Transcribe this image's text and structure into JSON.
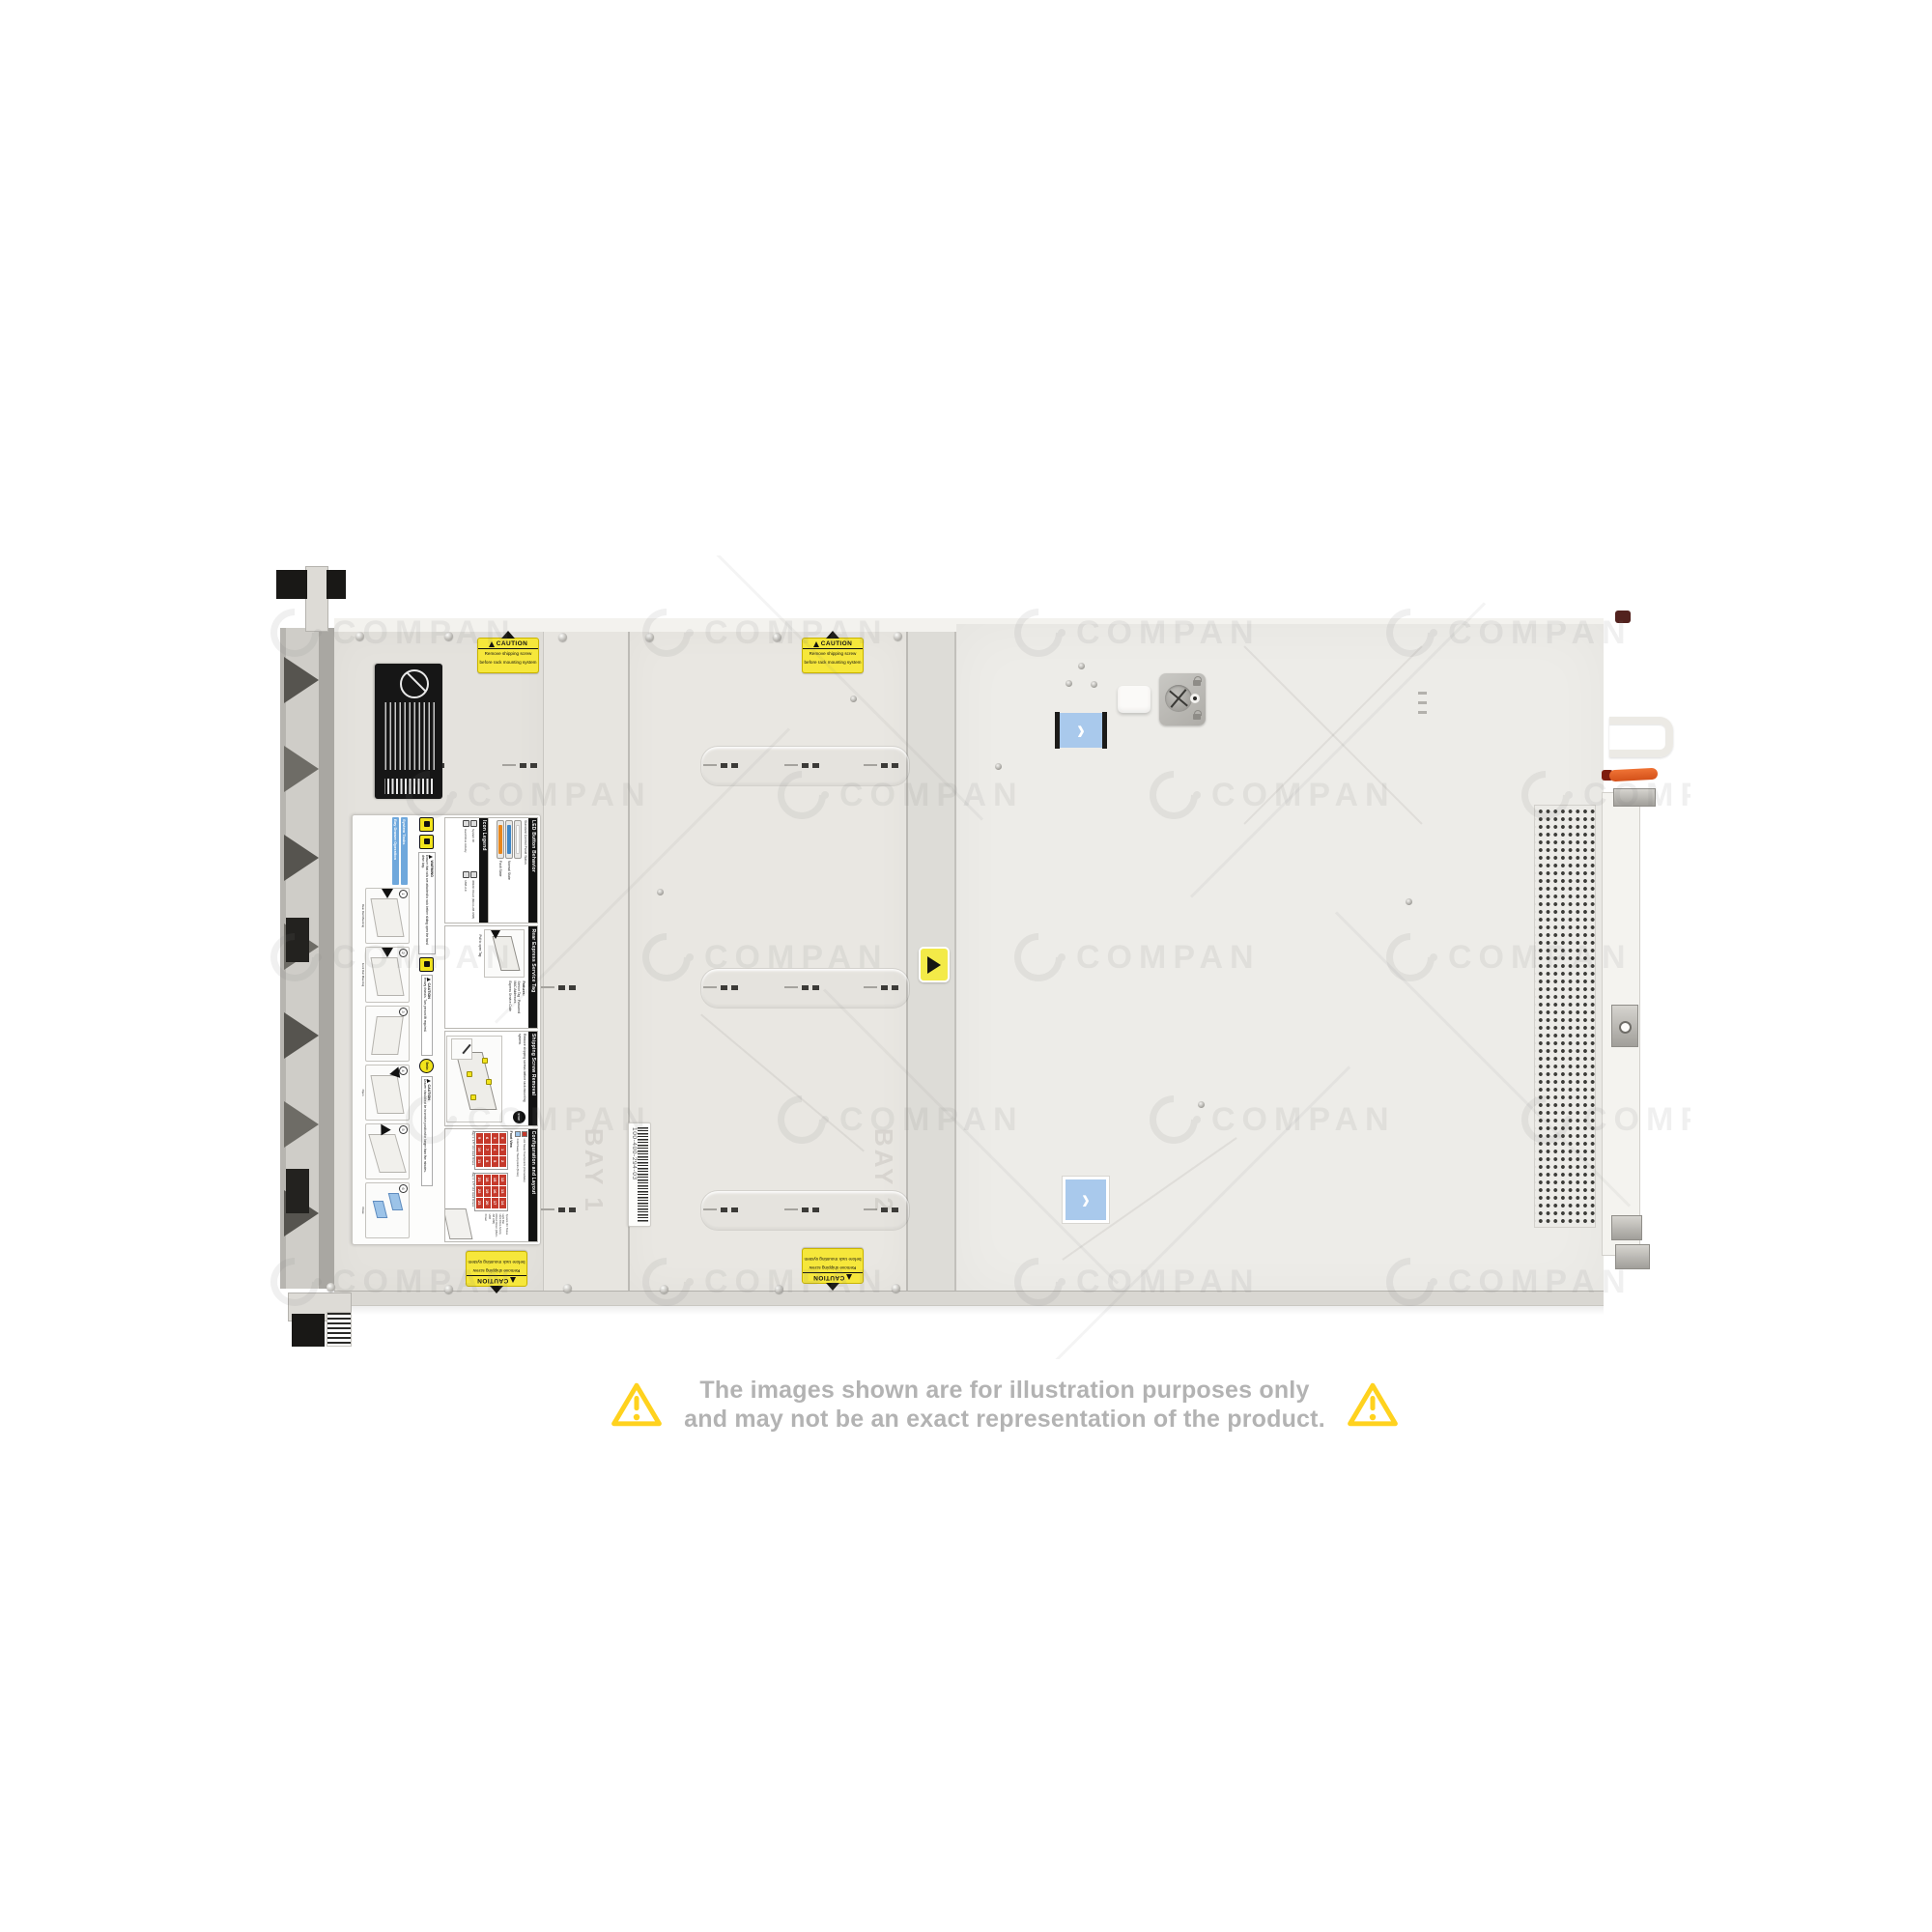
{
  "watermark": {
    "text": "COMPAN"
  },
  "disclaimer": {
    "line1": "The images shown are for illustration purposes only",
    "line2": "and may not be an exact representation of the product."
  },
  "caution_label": {
    "header": "CAUTION",
    "line1": "Remove shipping screw",
    "line2": "before rack mounting system"
  },
  "barcode_label": {
    "text": "100-400-294-03"
  },
  "embossed": {
    "bay1": "BAY 1",
    "bay2": "BAY 2"
  },
  "service_label": {
    "led_section": {
      "title": "LED Button Behavior",
      "subtitle": "Standard Control Panel Status",
      "states": [
        {
          "label": "",
          "color": "#fbfbfa"
        },
        {
          "label": "Normal State",
          "color": "#3f86c6"
        },
        {
          "label": "Fault State",
          "color": "#e8861a"
        }
      ]
    },
    "icon_legend": {
      "title": "Icon Legend",
      "items": [
        "System ID",
        "iDRAC Direct (Micro-AB USB)",
        "Hard Drive Activity",
        "USB 2.0"
      ]
    },
    "service_tag": {
      "title": "Rear Express Service Tag",
      "features_label": "Features:",
      "features": [
        "Service Tag",
        "Password",
        "MAC Addresses",
        "Express Service Code"
      ],
      "note": "Pull to open Tag"
    },
    "shipping": {
      "title": "Shipping Screw Removal",
      "badge": "STOP",
      "text": "Remove shipping screws before rack mounting system."
    },
    "config": {
      "title": "Configuration and Layout",
      "legend": [
        {
          "label": "Hot Swap Touchpoints (Immediate)",
          "color": "#c5392b"
        },
        {
          "label": "Cold Swap Touchpoints (5min)",
          "color": "#9cc3e8"
        }
      ],
      "front_view": "Front View",
      "bay1_label": "Bay 1: 3.5\" x12 Hard Drives",
      "bay2_label": "Bay 2: 3.5\" x12 Hard Drives",
      "bay1_numbers": [
        "0",
        "1",
        "2",
        "3",
        "4",
        "5",
        "6",
        "7",
        "8",
        "9",
        "10",
        "11"
      ],
      "bay2_numbers": [
        "12",
        "13",
        "14",
        "15",
        "16",
        "17",
        "18",
        "19",
        "20",
        "21",
        "22",
        "23"
      ],
      "annotations": [
        "System ID / Status Light Bar",
        "Hard Drive Activity",
        "iDRAC Direct (Micro-AB USB)",
        "USB",
        "Power"
      ]
    },
    "warnings": [
      {
        "type": "WARNING",
        "text": "Ensure that rails are attached to rack before sliding open the hard drive bay."
      },
      {
        "type": "CAUTION",
        "text": "Heavy chassis. Two person lift required."
      },
      {
        "type": "CAUTION",
        "badge": "5min",
        "text": "Drawer should not be in service position for longer than five minutes."
      }
    ],
    "tasks": {
      "header1": "System Tasks",
      "header2": "Bay Drawer Operation",
      "steps": [
        {
          "n": "1",
          "caption": "Rear Rail Mounting"
        },
        {
          "n": "2",
          "caption": "Front Rail Mounting"
        },
        {
          "n": "3",
          "caption": ""
        },
        {
          "n": "4",
          "caption": "Open"
        },
        {
          "n": "5",
          "caption": ""
        },
        {
          "n": "6",
          "caption": "Close"
        }
      ]
    }
  }
}
